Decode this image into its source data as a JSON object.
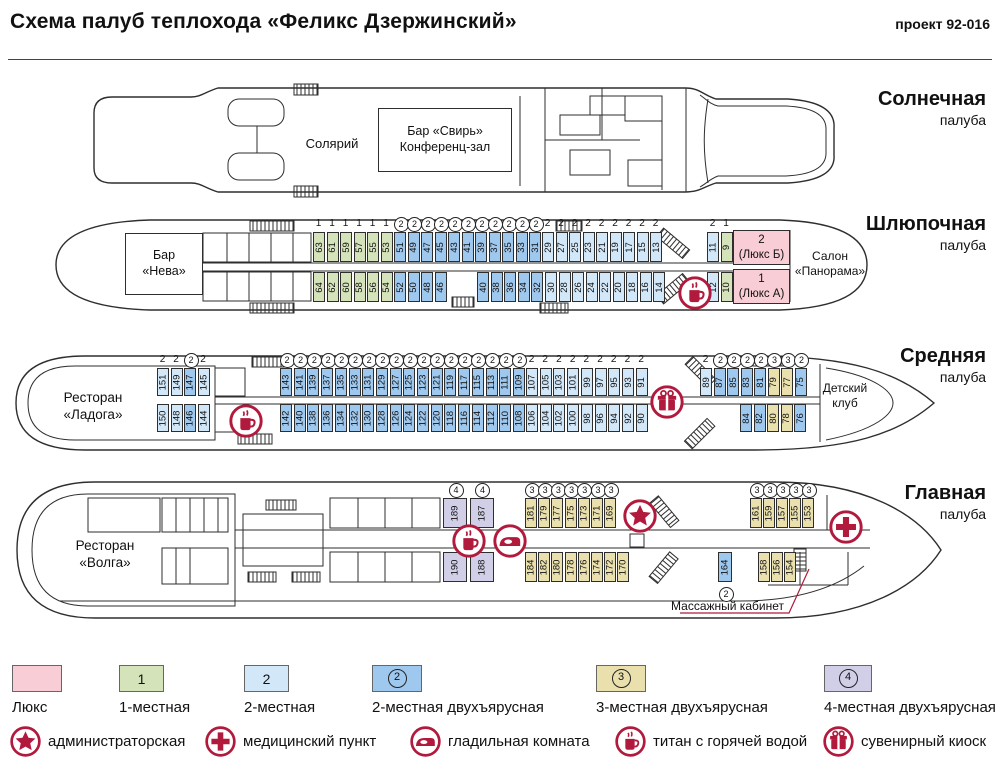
{
  "header": {
    "title": "Схема палуб теплохода «Феликс Дзержинский»",
    "project": "проект 92-016"
  },
  "colors": {
    "line": "#2e2e2e",
    "icon": "#b11a3c",
    "lux": "#f9cdd5",
    "single": "#d5e3ba",
    "double": "#d2e7f8",
    "double2": "#9fc8ef",
    "triple2": "#e9e0ad",
    "quad2": "#d1cfe8"
  },
  "decks": [
    {
      "id": "sun",
      "name": "Солнечная",
      "name_sub": "палуба",
      "name_y": 88,
      "rooms": [
        {
          "id": "room-bar-svir",
          "label": "Бар «Свирь»\nКонференц-зал",
          "x": 378,
          "y": 108,
          "w": 134,
          "h": 64,
          "fill": "white",
          "size": 12.5
        }
      ],
      "labels": [
        {
          "id": "solarium-label",
          "text": "Солярий",
          "x": 262,
          "y": 136,
          "w": 140,
          "size": 13
        }
      ],
      "cabin_groups": [],
      "icons": []
    },
    {
      "id": "boat",
      "name": "Шлюпочная",
      "name_sub": "палуба",
      "name_y": 213,
      "rooms": [
        {
          "id": "room-bar-neva",
          "label": "Бар\n«Нева»",
          "x": 125,
          "y": 233,
          "w": 78,
          "h": 62,
          "fill": "white",
          "size": 12.5
        },
        {
          "id": "cabin-lux-b",
          "label": "2\n(Люкс Б)",
          "x": 733,
          "y": 230,
          "w": 57,
          "h": 35,
          "fill": "lux",
          "size": 11.5
        },
        {
          "id": "cabin-lux-a",
          "label": "1\n(Люкс А)",
          "x": 733,
          "y": 269,
          "w": 57,
          "h": 35,
          "fill": "lux",
          "size": 11.5
        }
      ],
      "labels": [
        {
          "id": "salon-panorama-label",
          "text": "Салон\n«Панорама»",
          "x": 790,
          "y": 249,
          "w": 80,
          "size": 12
        }
      ],
      "cabin_groups": [
        {
          "row": "top",
          "x": 313,
          "y": 232,
          "w": 12,
          "h": 30,
          "pitch": 13.5,
          "marks": "above",
          "t": "single",
          "cabins": [
            "63",
            "61",
            "59",
            "57",
            "55",
            "53"
          ]
        },
        {
          "row": "top",
          "x": 394,
          "y": 232,
          "w": 12,
          "h": 30,
          "pitch": 13.5,
          "marks": "above",
          "t": "double2",
          "cabins": [
            "51",
            "49",
            "47",
            "45",
            "43",
            "41",
            "39",
            "37",
            "35",
            "33",
            "31"
          ]
        },
        {
          "row": "top",
          "x": 542,
          "y": 232,
          "w": 12,
          "h": 30,
          "pitch": 13.5,
          "marks": "above",
          "t": "double",
          "cabins": [
            "29",
            "27",
            "25",
            "23",
            "21",
            "19",
            "17",
            "15",
            "13"
          ]
        },
        {
          "row": "top",
          "x": 707,
          "y": 232,
          "w": 12,
          "h": 30,
          "pitch": 13.5,
          "marks": "above",
          "cabins": [
            {
              "n": "11",
              "t": "double"
            },
            {
              "n": "9",
              "t": "single"
            }
          ]
        },
        {
          "row": "bottom",
          "x": 313,
          "y": 272,
          "w": 12,
          "h": 30,
          "pitch": 13.5,
          "marks": "none",
          "t": "single",
          "cabins": [
            "64",
            "62",
            "60",
            "58",
            "56",
            "54"
          ]
        },
        {
          "row": "bottom",
          "x": 394,
          "y": 272,
          "w": 12,
          "h": 30,
          "pitch": 13.5,
          "marks": "none",
          "t": "double2",
          "cabins": [
            "52",
            "50",
            "48",
            "46"
          ]
        },
        {
          "row": "bottom",
          "x": 477,
          "y": 272,
          "w": 12,
          "h": 30,
          "pitch": 13.5,
          "marks": "none",
          "t": "double2",
          "cabins": [
            "40",
            "38",
            "36",
            "34",
            "32"
          ]
        },
        {
          "row": "bottom",
          "x": 545,
          "y": 272,
          "w": 12,
          "h": 30,
          "pitch": 13.5,
          "marks": "none",
          "t": "double",
          "cabins": [
            "30",
            "28",
            "26",
            "24",
            "22",
            "20",
            "18",
            "16",
            "14"
          ]
        },
        {
          "row": "bottom",
          "x": 707,
          "y": 272,
          "w": 12,
          "h": 30,
          "pitch": 13.5,
          "marks": "none",
          "cabins": [
            {
              "n": "12",
              "t": "double"
            },
            {
              "n": "10",
              "t": "single"
            }
          ]
        }
      ],
      "icons": [
        {
          "icon": "hot-water",
          "x": 695,
          "y": 293
        }
      ]
    },
    {
      "id": "middle",
      "name": "Средняя",
      "name_sub": "палуба",
      "name_y": 345,
      "rooms": [],
      "labels": [
        {
          "id": "restaurant-ladoga-label",
          "text": "Ресторан\n«Ладога»",
          "x": 28,
          "y": 390,
          "w": 130,
          "size": 13.5
        },
        {
          "id": "detskiy-klub-label",
          "text": "Детский\nклуб",
          "x": 805,
          "y": 381,
          "w": 80,
          "size": 12
        }
      ],
      "cabin_groups": [
        {
          "row": "top",
          "x": 157,
          "y": 368,
          "w": 12,
          "h": 28,
          "pitch": 13.5,
          "marks": "above",
          "cabins": [
            {
              "n": "151",
              "t": "double"
            },
            {
              "n": "149",
              "t": "double"
            },
            {
              "n": "147",
              "t": "double2"
            },
            {
              "n": "145",
              "t": "double"
            }
          ]
        },
        {
          "row": "top",
          "x": 280,
          "y": 368,
          "w": 12,
          "h": 28,
          "pitch": 13.7,
          "marks": "above",
          "t": "double2",
          "cabins": [
            "143",
            "141",
            "139",
            "137",
            "135",
            "133",
            "131",
            "129",
            "127",
            "125",
            "123",
            "121",
            "119",
            "117",
            "115",
            "113",
            "111",
            "109"
          ]
        },
        {
          "row": "top",
          "x": 526,
          "y": 368,
          "w": 12,
          "h": 28,
          "pitch": 13.7,
          "marks": "above",
          "t": "double",
          "cabins": [
            "107",
            "105",
            "103",
            "101",
            "99",
            "97",
            "95",
            "93",
            "91"
          ]
        },
        {
          "row": "top",
          "x": 700,
          "y": 368,
          "w": 12,
          "h": 28,
          "pitch": 13.5,
          "marks": "above",
          "cabins": [
            {
              "n": "89",
              "t": "double"
            },
            {
              "n": "87",
              "t": "double2"
            },
            {
              "n": "85",
              "t": "double2"
            },
            {
              "n": "83",
              "t": "double2"
            },
            {
              "n": "81",
              "t": "double2"
            },
            {
              "n": "79",
              "t": "triple2"
            },
            {
              "n": "77",
              "t": "triple2"
            },
            {
              "n": "75",
              "t": "double2"
            }
          ]
        },
        {
          "row": "bottom",
          "x": 157,
          "y": 404,
          "w": 12,
          "h": 28,
          "pitch": 13.5,
          "marks": "none",
          "cabins": [
            {
              "n": "150",
              "t": "double"
            },
            {
              "n": "148",
              "t": "double"
            },
            {
              "n": "146",
              "t": "double2"
            },
            {
              "n": "144",
              "t": "double"
            }
          ]
        },
        {
          "row": "bottom",
          "x": 280,
          "y": 404,
          "w": 12,
          "h": 28,
          "pitch": 13.7,
          "marks": "none",
          "t": "double2",
          "cabins": [
            "142",
            "140",
            "138",
            "136",
            "134",
            "132",
            "130",
            "128",
            "126",
            "124",
            "122",
            "120",
            "118",
            "116",
            "114",
            "112",
            "110",
            "108"
          ]
        },
        {
          "row": "bottom",
          "x": 526,
          "y": 404,
          "w": 12,
          "h": 28,
          "pitch": 13.7,
          "marks": "none",
          "t": "double",
          "cabins": [
            "106",
            "104",
            "102",
            "100",
            "98",
            "96",
            "94",
            "92",
            "90"
          ]
        },
        {
          "row": "bottom",
          "x": 740,
          "y": 404,
          "w": 12,
          "h": 28,
          "pitch": 13.5,
          "marks": "none",
          "cabins": [
            {
              "n": "84",
              "t": "double2"
            },
            {
              "n": "82",
              "t": "double2"
            },
            {
              "n": "80",
              "t": "triple2"
            },
            {
              "n": "78",
              "t": "triple2"
            },
            {
              "n": "76",
              "t": "double2"
            }
          ]
        }
      ],
      "icons": [
        {
          "icon": "hot-water",
          "x": 246,
          "y": 421
        },
        {
          "icon": "gift",
          "x": 667,
          "y": 402
        }
      ]
    },
    {
      "id": "main",
      "name": "Главная",
      "name_sub": "палуба",
      "name_y": 482,
      "rooms": [],
      "labels": [
        {
          "id": "restaurant-volga-label",
          "text": "Ресторан\n«Волга»",
          "x": 40,
          "y": 538,
          "w": 130,
          "size": 13.5
        },
        {
          "id": "massage-label",
          "text": "Массажный кабинет",
          "x": 660,
          "y": 599,
          "w": 135,
          "size": 12
        }
      ],
      "cabin_groups": [
        {
          "row": "top",
          "x": 443,
          "y": 498,
          "w": 24,
          "h": 30,
          "pitch": 26.5,
          "marks": "above",
          "t": "quad2",
          "cabins": [
            "189",
            "187"
          ]
        },
        {
          "row": "top",
          "x": 525,
          "y": 498,
          "w": 12,
          "h": 30,
          "pitch": 13.2,
          "marks": "above",
          "t": "triple2",
          "cabins": [
            "181",
            "179",
            "177",
            "175",
            "173",
            "171",
            "169"
          ]
        },
        {
          "row": "top",
          "x": 750,
          "y": 498,
          "w": 12,
          "h": 30,
          "pitch": 13,
          "marks": "above",
          "t": "triple2",
          "cabins": [
            "161",
            "159",
            "157",
            "155",
            "153"
          ]
        },
        {
          "row": "bottom",
          "x": 443,
          "y": 552,
          "w": 24,
          "h": 30,
          "pitch": 26.5,
          "marks": "none",
          "t": "quad2",
          "cabins": [
            "190",
            "188"
          ]
        },
        {
          "row": "bottom",
          "x": 525,
          "y": 552,
          "w": 12,
          "h": 30,
          "pitch": 13.2,
          "marks": "none",
          "t": "triple2",
          "cabins": [
            "184",
            "182",
            "180",
            "178",
            "176",
            "174",
            "172",
            "170"
          ]
        },
        {
          "row": "bottom",
          "x": 718,
          "y": 552,
          "w": 14,
          "h": 30,
          "pitch": 14,
          "marks": "none",
          "cabins": [
            {
              "n": "164",
              "t": "double2",
              "mb": true
            }
          ]
        },
        {
          "row": "bottom",
          "x": 758,
          "y": 552,
          "w": 12,
          "h": 30,
          "pitch": 13,
          "marks": "none",
          "t": "triple2",
          "cabins": [
            "158",
            "156",
            "154"
          ]
        }
      ],
      "icons": [
        {
          "icon": "hot-water",
          "x": 469,
          "y": 541
        },
        {
          "icon": "iron",
          "x": 510,
          "y": 541
        },
        {
          "icon": "star",
          "x": 640,
          "y": 516
        },
        {
          "icon": "medical",
          "x": 846,
          "y": 527
        }
      ]
    }
  ],
  "legend": {
    "types": [
      {
        "key": "lux",
        "label": "Люкс",
        "badge": "",
        "circled": false,
        "x": 12,
        "w": 50
      },
      {
        "key": "single",
        "label": "1-местная",
        "badge": "1",
        "circled": false,
        "x": 119,
        "w": 45
      },
      {
        "key": "double",
        "label": "2-местная",
        "badge": "2",
        "circled": false,
        "x": 244,
        "w": 45
      },
      {
        "key": "double2",
        "label": "2-местная двухъярусная",
        "badge": "2",
        "circled": true,
        "x": 372,
        "w": 50
      },
      {
        "key": "triple2",
        "label": "3-местная двухъярусная",
        "badge": "3",
        "circled": true,
        "x": 596,
        "w": 50
      },
      {
        "key": "quad2",
        "label": "4-местная двухъярусная",
        "badge": "4",
        "circled": true,
        "x": 824,
        "w": 48
      }
    ],
    "icons": [
      {
        "icon": "star",
        "label": "администраторская",
        "x": 10
      },
      {
        "icon": "medical",
        "label": "медицинский пункт",
        "x": 205
      },
      {
        "icon": "iron",
        "label": "гладильная комната",
        "x": 410
      },
      {
        "icon": "hot-water",
        "label": "титан с горячей водой",
        "x": 615
      },
      {
        "icon": "gift",
        "label": "сувенирный киоск",
        "x": 823
      }
    ]
  },
  "marks_map": {
    "single": "1",
    "double": "2",
    "double2": "2",
    "triple2": "3",
    "quad2": "4"
  },
  "circled_types": [
    "double2",
    "triple2",
    "quad2"
  ]
}
